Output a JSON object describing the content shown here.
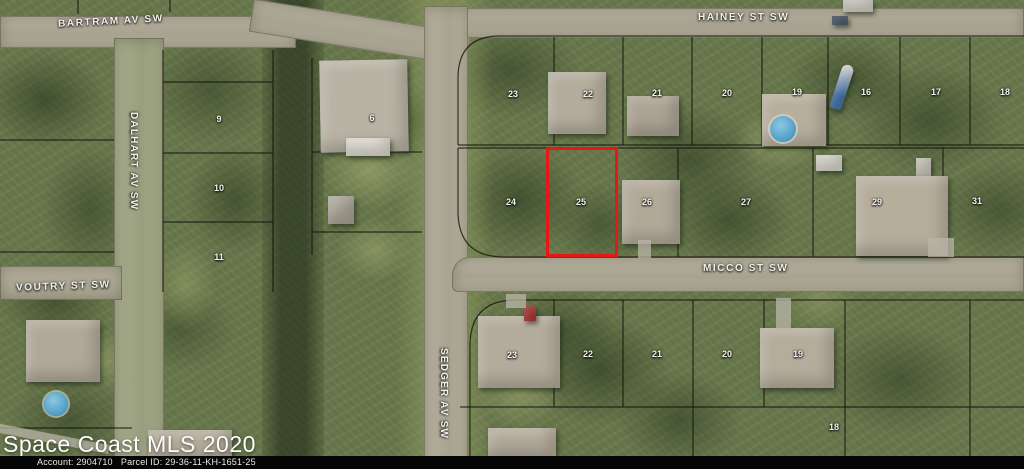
{
  "map": {
    "streets": {
      "bartram": "BARTRAM AV SW",
      "hainey": "HAINEY ST SW",
      "dalhart": "DALHART AV SW",
      "sedger": "SEDGER AV SW",
      "micco": "MICCO ST SW",
      "voutry": "VOUTRY ST SW"
    },
    "highlight_color": "#e81717",
    "pool_color": "#4f9cc4",
    "lots": [
      {
        "n": "23",
        "x": 513,
        "y": 94
      },
      {
        "n": "22",
        "x": 588,
        "y": 94
      },
      {
        "n": "21",
        "x": 657,
        "y": 93
      },
      {
        "n": "20",
        "x": 727,
        "y": 93
      },
      {
        "n": "19",
        "x": 797,
        "y": 92
      },
      {
        "n": "16",
        "x": 866,
        "y": 92
      },
      {
        "n": "17",
        "x": 936,
        "y": 92
      },
      {
        "n": "18",
        "x": 1005,
        "y": 92
      },
      {
        "n": "24",
        "x": 511,
        "y": 202
      },
      {
        "n": "25",
        "x": 581,
        "y": 202
      },
      {
        "n": "26",
        "x": 647,
        "y": 202
      },
      {
        "n": "27",
        "x": 746,
        "y": 202
      },
      {
        "n": "29",
        "x": 877,
        "y": 202
      },
      {
        "n": "31",
        "x": 977,
        "y": 201
      },
      {
        "n": "23",
        "x": 512,
        "y": 355
      },
      {
        "n": "22",
        "x": 588,
        "y": 354
      },
      {
        "n": "21",
        "x": 657,
        "y": 354
      },
      {
        "n": "20",
        "x": 727,
        "y": 354
      },
      {
        "n": "19",
        "x": 798,
        "y": 354
      },
      {
        "n": "18",
        "x": 834,
        "y": 427
      },
      {
        "n": "9",
        "x": 219,
        "y": 119
      },
      {
        "n": "10",
        "x": 219,
        "y": 188
      },
      {
        "n": "11",
        "x": 219,
        "y": 257
      },
      {
        "n": "6",
        "x": 372,
        "y": 118
      }
    ]
  },
  "watermark": "Space Coast MLS 2020",
  "footer": {
    "account_label": "Account:",
    "account_value": "2904710",
    "parcel_label": "Parcel ID:",
    "parcel_value": "29-36-11-KH-1651-25"
  }
}
